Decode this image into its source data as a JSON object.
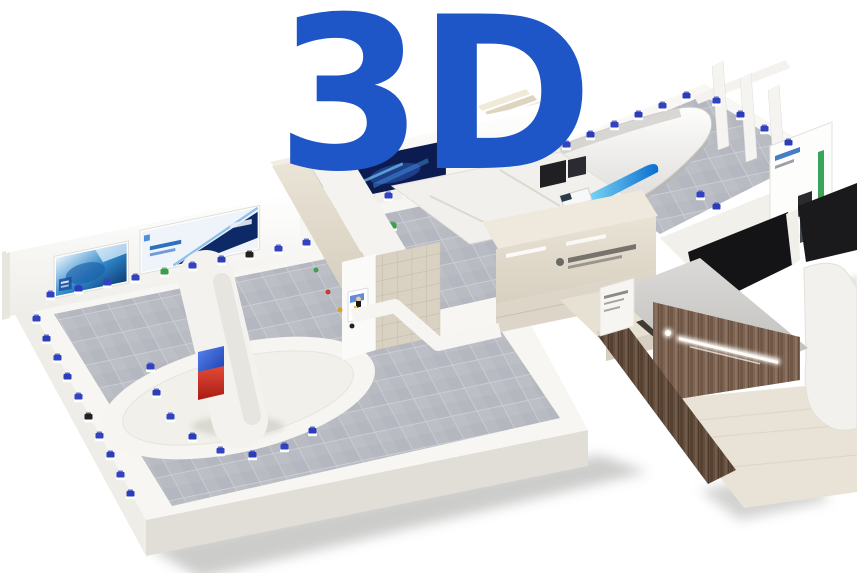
{
  "logo": {
    "text": "3D",
    "color": "#1E56C8"
  },
  "palette": {
    "background": "#FFFFFF",
    "slab": "#F7F6F2",
    "wall": "#FBFBF9",
    "floor_tile": "#B8BBC2",
    "marble": "#E0D9CA",
    "beige_tile": "#D9D2C4",
    "wood": "#7A614E",
    "roof": "#C9C8C5",
    "banner_navy": "#0D1C50",
    "banner_blue": "#2F7FD0",
    "banner_light": "#EEF4FA",
    "hull_white": "#FAFAF8",
    "dark_panel": "#141417",
    "screen_red": "#D03028",
    "screen_blue": "#2A50CC",
    "display_cyan": "#6FD0F2",
    "exhibit_blue": "#3243C0",
    "exhibit_navy": "#2B3DB8",
    "exhibit_green": "#3F9E4E",
    "exhibit_red": "#C23A3A",
    "exhibit_gold": "#D4A12C",
    "exhibit_black": "#222222",
    "apron": "#E9E3D7",
    "shadow": "#8F8F8D",
    "sign_glow": "#FFFFFF"
  },
  "landmarks": {
    "west_hall": "main-exhibition-hall-west",
    "north_hall": "exhibition-hall-north",
    "east_hall": "exhibition-hall-east",
    "center_block": "central-marble-block",
    "entrance": "wood-entrance-lobby",
    "feature": "turbine-hull-exhibit",
    "tower": "center-display-tower"
  }
}
